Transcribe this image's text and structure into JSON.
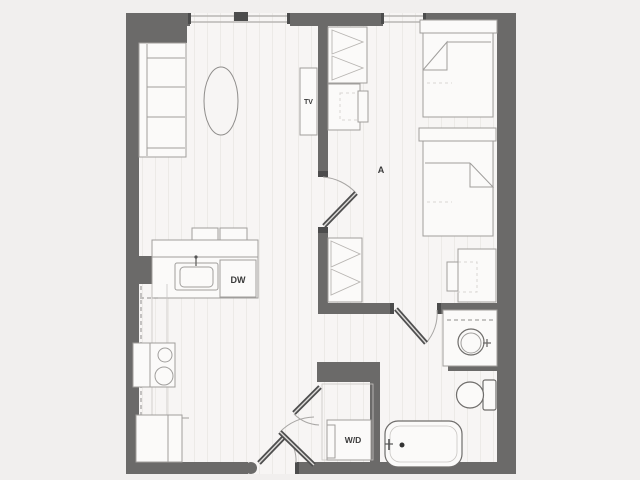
{
  "plan": {
    "labels": {
      "tv": "TV",
      "bedroom": "A",
      "dishwasher": "DW",
      "washer_dryer": "W/D"
    }
  },
  "colors": {
    "background": "#f1efee",
    "floor": "#f7f5f4",
    "plank_line": "#eceae7",
    "wall": "#6b6a69",
    "furniture_fill": "#fbfaf9",
    "furniture_stroke": "#a09e9c",
    "fixture_stroke": "#6f6d6b",
    "door_panel": "#4f4f4f",
    "arc_stroke": "#a8a6a4",
    "label_text": "#3a3a3a"
  }
}
